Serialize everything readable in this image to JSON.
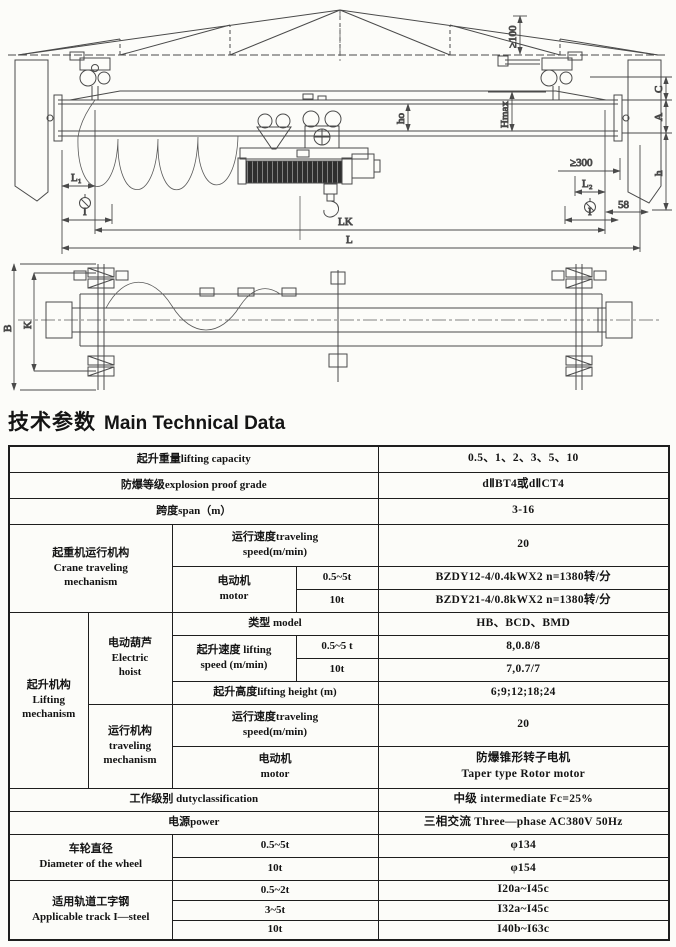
{
  "meta": {
    "title_cn": "技术参数",
    "title_en": "Main Technical Data"
  },
  "colors": {
    "paper": "#fcfcf9",
    "line": "#4a4a4a",
    "ink": "#141414",
    "drum_fill": "#2e2e2e"
  },
  "front_view": {
    "dims": {
      "gte100": "≥100",
      "hmax": "Hmax",
      "ho": "ho",
      "c": "C",
      "a": "A",
      "h": "h",
      "gte300": "≥300",
      "n58": "58",
      "l1": "L₁",
      "l2": "L₂",
      "i_left": "I",
      "i_right": "I",
      "lk": "LK",
      "l": "L"
    }
  },
  "plan_view": {
    "dims": {
      "b": "B",
      "k": "K"
    }
  },
  "table": {
    "lifting_capacity": {
      "label": "起升重量lifting capacity",
      "value": "0.5、1、2、3、5、10"
    },
    "explosion_grade": {
      "label": "防爆等级explosion proof grade",
      "value": "dⅡBT4或dⅡCT4"
    },
    "span": {
      "label": "跨度span（m）",
      "value": "3-16"
    },
    "crane_traveling": {
      "group_label": "起重机运行机构\nCrane traveling\nmechanism",
      "speed_label": "运行速度traveling\nspeed(m/min)",
      "speed_value": "20",
      "motor_label": "电动机\nmotor",
      "motor_row1_cond": "0.5~5t",
      "motor_row1_value": "BZDY12-4/0.4kWX2 n=1380转/分",
      "motor_row2_cond": "10t",
      "motor_row2_value": "BZDY21-4/0.8kWX2 n=1380转/分"
    },
    "lifting_mechanism": {
      "group_label": "起升机构\nLifting\nmechanism",
      "hoist_label": "电动葫芦\nElectric\nhoist",
      "model_label": "类型  model",
      "model_value": "HB、BCD、BMD",
      "lift_speed_label": "起升速度 lifting\nspeed (m/min)",
      "lift_speed_row1_cond": "0.5~5 t",
      "lift_speed_row1_value": "8,0.8/8",
      "lift_speed_row2_cond": "10t",
      "lift_speed_row2_value": "7,0.7/7",
      "lift_height_label": "起升高度lifting height (m)",
      "lift_height_value": "6;9;12;18;24",
      "trav_label": "运行机构\ntraveling\nmechanism",
      "trav_speed_label": "运行速度traveling\nspeed(m/min)",
      "trav_speed_value": "20",
      "trav_motor_label": "电动机\nmotor",
      "trav_motor_value": "防爆锥形转子电机\nTaper type Rotor motor"
    },
    "duty": {
      "label": "工作级别  dutyclassification",
      "value": "中级  intermediate Fc=25%"
    },
    "power": {
      "label": "电源power",
      "value": "三相交流  Three—phase AC380V 50Hz"
    },
    "wheel": {
      "group_label": "车轮直径\nDiameter of the wheel",
      "row1_cond": "0.5~5t",
      "row1_value": "φ134",
      "row2_cond": "10t",
      "row2_value": "φ154"
    },
    "track": {
      "group_label": "适用轨道工字钢\nApplicable track I—steel",
      "row1_cond": "0.5~2t",
      "row1_value": "I20a~I45c",
      "row2_cond": "3~5t",
      "row2_value": "I32a~I45c",
      "row3_cond": "10t",
      "row3_value": "I40b~I63c"
    }
  }
}
